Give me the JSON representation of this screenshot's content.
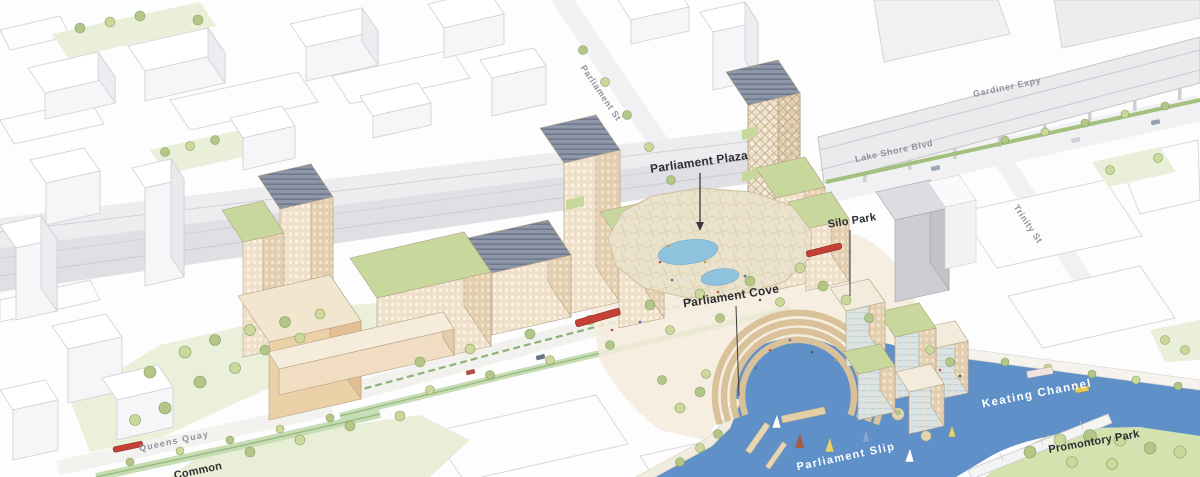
{
  "scene": {
    "type": "illustrated-aerial-masterplan",
    "description": "Axonometric watercolor-style rendering of a timber-building waterfront district between a rail corridor / elevated expressway and a boat-filled slip and channel"
  },
  "palette": {
    "water": "#6090c8",
    "pond": "#8fc2dd",
    "park_green": "#ebf0da",
    "promontory_green": "#d4e2b0",
    "tree_green": "#b3c687",
    "building_tan": "#eedfc8",
    "building_tan_shade": "#e3cfb2",
    "canopy": "#ebe2cc",
    "context_white": "#fdfdfe",
    "road_gray": "#f1f1f4",
    "rail_gray": "#dfdfe4",
    "streetcar_red": "#c54036",
    "label_dark": "#2e2e32",
    "label_gray": "#90939a",
    "label_white": "#ffffff"
  },
  "labels": {
    "parliament_st": {
      "text": "Parliament St",
      "kind": "street",
      "has_leader": false
    },
    "gardiner_expy": {
      "text": "Gardiner Expy",
      "kind": "street",
      "has_leader": false
    },
    "lake_shore_blvd": {
      "text": "Lake Shore Blvd",
      "kind": "street",
      "has_leader": false
    },
    "trinity_st": {
      "text": "Trinity St",
      "kind": "street",
      "has_leader": false
    },
    "queens_quay": {
      "text": "Queens Quay",
      "kind": "street",
      "has_leader": false
    },
    "parliament_plaza": {
      "text": "Parliament Plaza",
      "kind": "place",
      "has_leader": true
    },
    "silo_park": {
      "text": "Silo Park",
      "kind": "place",
      "has_leader": true
    },
    "parliament_cove": {
      "text": "Parliament Cove",
      "kind": "place",
      "has_leader": true
    },
    "promontory_park": {
      "text": "Promontory Park",
      "kind": "place",
      "has_leader": false
    },
    "common": {
      "text": "Common",
      "kind": "place",
      "has_leader": false
    },
    "keating_channel": {
      "text": "Keating Channel",
      "kind": "water",
      "has_leader": false
    },
    "parliament_slip": {
      "text": "Parliament Slip",
      "kind": "water",
      "has_leader": false
    }
  }
}
